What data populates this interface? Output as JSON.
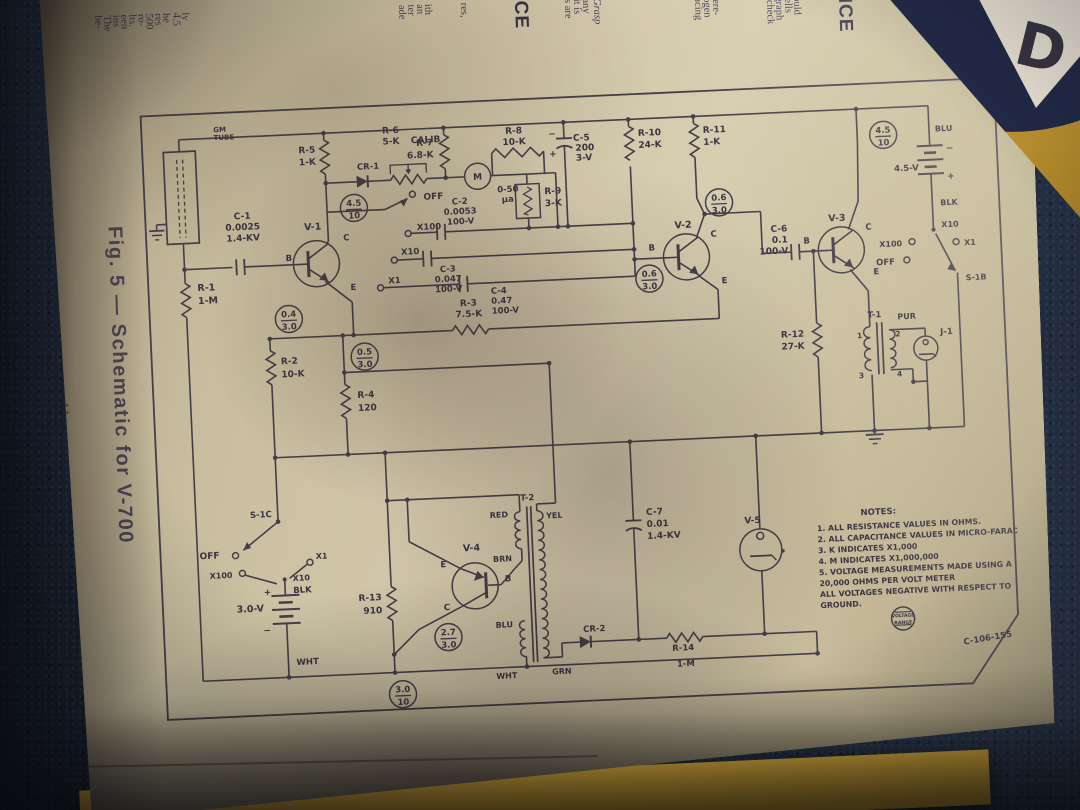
{
  "figure": {
    "caption": "Fig. 5 — Schematic for V-700",
    "page_number": "11",
    "plate_number": "C-106-155"
  },
  "cover": {
    "logo_letter": "D"
  },
  "colors": {
    "page": "#d3c8ab",
    "carpet": "#2c3950",
    "cover_yellow": "#d8ab3a",
    "logo_navy": "#232b4a",
    "logo_red": "#bf3240",
    "ink": "#3a3443"
  },
  "page_top_fragments": [
    {
      "x": 64,
      "t": "be-"
    },
    {
      "x": 73,
      "t": "The"
    },
    {
      "x": 82,
      "t": "ins"
    },
    {
      "x": 90,
      "t": "een"
    },
    {
      "x": 98,
      "t": "lts."
    },
    {
      "x": 107,
      "t": "ro-"
    },
    {
      "x": 115,
      "t": "500"
    },
    {
      "x": 124,
      "t": "res"
    },
    {
      "x": 132,
      "t": "he"
    },
    {
      "x": 142,
      "t": "4.5"
    },
    {
      "x": 151,
      "t": "ly"
    },
    {
      "x": 368,
      "t": "ade"
    },
    {
      "x": 377,
      "t": "ter"
    },
    {
      "x": 386,
      "t": "an"
    },
    {
      "x": 394,
      "t": "ith"
    },
    {
      "x": 430,
      "t": "res,"
    },
    {
      "x": 492,
      "t": "CE",
      "b": 1
    },
    {
      "x": 534,
      "t": "s are"
    },
    {
      "x": 543,
      "t": "it is"
    },
    {
      "x": 552,
      "t": "any"
    },
    {
      "x": 563,
      "t": "Grasp",
      "i": 1
    },
    {
      "x": 664,
      "t": "lacing"
    },
    {
      "x": 673,
      "t": "logen"
    },
    {
      "x": 682,
      "t": "here-"
    },
    {
      "x": 736,
      "t": "1 check"
    },
    {
      "x": 745,
      "t": "agraph"
    },
    {
      "x": 754,
      "t": "Cells"
    },
    {
      "x": 763,
      "t": "hould"
    },
    {
      "x": 816,
      "t": "NCE",
      "b": 1
    }
  ],
  "schematic": {
    "labels": [
      [
        75,
        22,
        "GM",
        7,
        "start"
      ],
      [
        75,
        30,
        "TUBE",
        7,
        "start"
      ],
      [
        100,
        110,
        "C-1",
        9
      ],
      [
        100,
        121,
        "0.0025",
        9
      ],
      [
        100,
        132,
        "1.4-KV",
        9
      ],
      [
        52,
        180,
        "R-1",
        9.5,
        "start"
      ],
      [
        52,
        193,
        "1-M",
        9.5,
        "start"
      ],
      [
        170,
        124,
        "V-1",
        9.5
      ],
      [
        148,
        154,
        "B",
        8.5,
        "end"
      ],
      [
        200,
        136,
        "C",
        8.5,
        "start"
      ],
      [
        205,
        186,
        "E",
        8.5,
        "start"
      ],
      [
        176,
        47,
        "R-5",
        9,
        "end"
      ],
      [
        176,
        59,
        "1-K",
        9,
        "end"
      ],
      [
        228,
        66,
        "CR-1",
        8.5
      ],
      [
        252,
        31,
        "R-6",
        9
      ],
      [
        252,
        42,
        "5-K",
        9
      ],
      [
        272,
        42,
        "CALIB",
        9,
        "start"
      ],
      [
        282,
        99,
        "OFF",
        9,
        "start"
      ],
      [
        274,
        129,
        "X100",
        8.5,
        "start"
      ],
      [
        318,
        105,
        "C-2",
        8.5
      ],
      [
        318,
        115,
        "0.0053",
        8.5
      ],
      [
        318,
        125,
        "100-V",
        8.5
      ],
      [
        257,
        153,
        "X10",
        8.5,
        "start"
      ],
      [
        303,
        172,
        "C-3",
        8.5
      ],
      [
        303,
        182,
        "0.047",
        8.5
      ],
      [
        303,
        192,
        "100-V",
        8.5
      ],
      [
        243,
        181,
        "X1",
        8.5,
        "start"
      ],
      [
        345,
        196,
        "C-4",
        8.5,
        "start"
      ],
      [
        345,
        206,
        "0.47",
        8.5,
        "start"
      ],
      [
        345,
        216,
        "100-V",
        8.5,
        "start"
      ],
      [
        294,
        45,
        "R-7",
        9,
        "end"
      ],
      [
        294,
        57,
        "6.8-K",
        9,
        "end"
      ],
      [
        337,
        81.5,
        "M",
        9
      ],
      [
        356,
        95,
        "0-50",
        8.5,
        "start"
      ],
      [
        360,
        105,
        "µa",
        8.5,
        "start"
      ],
      [
        375,
        37,
        "R-8",
        9
      ],
      [
        375,
        48,
        "10-K",
        9
      ],
      [
        403,
        99,
        "R-9",
        9,
        "start"
      ],
      [
        403,
        111,
        "3-K",
        9,
        "start"
      ],
      [
        434,
        47,
        "C-5",
        9,
        "start"
      ],
      [
        436,
        57,
        "200",
        9,
        "start"
      ],
      [
        436,
        67,
        "3-V",
        9,
        "start"
      ],
      [
        417,
        42,
        "−",
        9,
        "end"
      ],
      [
        417,
        62,
        "+",
        9,
        "end"
      ],
      [
        499,
        45,
        "R-10",
        9,
        "start"
      ],
      [
        499,
        57,
        "24-K",
        9,
        "start"
      ],
      [
        564,
        45,
        "R-11",
        9,
        "start"
      ],
      [
        564,
        57,
        "1-K",
        9,
        "start"
      ],
      [
        540,
        139,
        "V-2",
        9.5
      ],
      [
        511,
        160,
        "B",
        8.5,
        "end"
      ],
      [
        567,
        149,
        "C",
        8.5,
        "start"
      ],
      [
        576,
        196,
        "E",
        8.5,
        "start"
      ],
      [
        322,
        207,
        "R-3",
        9
      ],
      [
        322,
        218,
        "7.5-K",
        9
      ],
      [
        132,
        257,
        "R-2",
        9,
        "start"
      ],
      [
        132,
        270,
        "10-K",
        9,
        "start"
      ],
      [
        207,
        294,
        "R-4",
        9,
        "start"
      ],
      [
        207,
        307,
        "120",
        9,
        "start"
      ],
      [
        644,
        147,
        "C-6",
        9,
        "end"
      ],
      [
        644,
        158,
        "0.1",
        9,
        "end"
      ],
      [
        644,
        169,
        "100-V",
        9,
        "end"
      ],
      [
        694,
        139,
        "V-3",
        9.5
      ],
      [
        666,
        160,
        "B",
        8.5,
        "end"
      ],
      [
        722,
        149,
        "C",
        8.5,
        "start"
      ],
      [
        728,
        194,
        "E",
        8.5,
        "start"
      ],
      [
        796,
        54,
        "BLU",
        8,
        "start"
      ],
      [
        778,
        92,
        "4.5-V",
        8.5,
        "end"
      ],
      [
        806,
        74,
        "−",
        9,
        "start"
      ],
      [
        806,
        102,
        "+",
        9,
        "start"
      ],
      [
        798,
        128,
        "BLK",
        8,
        "start"
      ],
      [
        798,
        150,
        "X10",
        8,
        "start"
      ],
      [
        758,
        167,
        "X100",
        8,
        "end"
      ],
      [
        820,
        169,
        "X1",
        8,
        "start"
      ],
      [
        750,
        185,
        "OFF",
        8.5,
        "end"
      ],
      [
        820,
        204,
        "S-1B",
        8,
        "start"
      ],
      [
        656,
        253,
        "R-12",
        9,
        "end"
      ],
      [
        656,
        265,
        "27-K",
        9,
        "end"
      ],
      [
        727,
        237,
        "T-1",
        8.5
      ],
      [
        750,
        240,
        "PUR",
        8,
        "start"
      ],
      [
        714,
        257,
        "1",
        7.5,
        "end"
      ],
      [
        747,
        257,
        "2",
        7.5,
        "start"
      ],
      [
        714,
        297,
        "3",
        7.5,
        "end"
      ],
      [
        747,
        297,
        "4",
        7.5,
        "start"
      ],
      [
        792,
        257,
        "J-1",
        8.5,
        "start"
      ],
      [
        116,
        409,
        "S-1C",
        8.5,
        "end"
      ],
      [
        62,
        448,
        "OFF",
        9,
        "end"
      ],
      [
        74,
        468,
        "X100",
        8,
        "end"
      ],
      [
        134,
        474,
        "X10",
        8,
        "start"
      ],
      [
        158,
        453,
        "X1",
        8,
        "start"
      ],
      [
        112,
        487,
        "+",
        9,
        "end"
      ],
      [
        104,
        503,
        "3.0-V",
        9.5,
        "end"
      ],
      [
        110,
        525,
        "−",
        9,
        "end"
      ],
      [
        134,
        486,
        "BLK",
        8.5,
        "start"
      ],
      [
        134,
        558,
        "WHT",
        8.5,
        "start"
      ],
      [
        222,
        497,
        "R-13",
        9,
        "end"
      ],
      [
        222,
        510,
        "910",
        9,
        "end"
      ],
      [
        314,
        452,
        "V-4",
        9.5
      ],
      [
        288,
        467,
        "E",
        8.5,
        "end"
      ],
      [
        346,
        484,
        "B",
        8.5,
        "start"
      ],
      [
        290,
        510,
        "C",
        8.5,
        "end"
      ],
      [
        372,
        404,
        "T-2",
        8.5
      ],
      [
        352,
        420,
        "RED",
        8,
        "end"
      ],
      [
        390,
        423,
        "YEL",
        8,
        "start"
      ],
      [
        354,
        464,
        "BRN",
        8,
        "end"
      ],
      [
        352,
        530,
        "BLU",
        8,
        "end"
      ],
      [
        354,
        581,
        "WHT",
        8,
        "end"
      ],
      [
        389,
        579,
        "GRN",
        8,
        "start"
      ],
      [
        490,
        424,
        "C-7",
        9,
        "start"
      ],
      [
        490,
        436,
        "0.01",
        9,
        "start"
      ],
      [
        490,
        448,
        "1.4-KV",
        9,
        "start"
      ],
      [
        596,
        437,
        "V-5",
        9
      ],
      [
        433,
        538,
        "CR-2",
        8.5
      ],
      [
        521,
        561,
        "R-14",
        8.5
      ],
      [
        523,
        577,
        "1-M",
        8.5
      ],
      [
        826,
        565,
        "C-106-155",
        8.5,
        "middle",
        -7
      ]
    ],
    "volt_circles": [
      {
        "x": 212,
        "y": 104,
        "top": "4.5",
        "bot": "10"
      },
      {
        "x": 744,
        "y": 55,
        "top": "4.5",
        "bot": "10"
      },
      {
        "x": 142,
        "y": 212,
        "top": "0.4",
        "bot": "3.0"
      },
      {
        "x": 216,
        "y": 253,
        "top": "0.5",
        "bot": "3.0"
      },
      {
        "x": 504,
        "y": 188,
        "top": "0.6",
        "bot": "3.0"
      },
      {
        "x": 577,
        "y": 115,
        "top": "0.6",
        "bot": "3.0"
      },
      {
        "x": 287,
        "y": 537,
        "top": "2.7",
        "bot": "3.0"
      },
      {
        "x": 239,
        "y": 592,
        "top": "3.0",
        "bot": "10"
      }
    ],
    "notes": {
      "title": "NOTES:",
      "lines": [
        "1. ALL RESISTANCE VALUES IN OHMS.",
        "2. ALL CAPACITANCE VALUES IN MICRO-FARADS.",
        "3. K INDICATES X1,000",
        "4. M INDICATES X1,000,000",
        "5. VOLTAGE MEASUREMENTS MADE USING A",
        "    20,000 OHMS PER VOLT METER",
        "    ALL VOLTAGES NEGATIVE WITH RESPECT TO",
        "    GROUND."
      ]
    },
    "stamp": {
      "line1": "VOLTAGE",
      "line2": "RANGE"
    }
  }
}
